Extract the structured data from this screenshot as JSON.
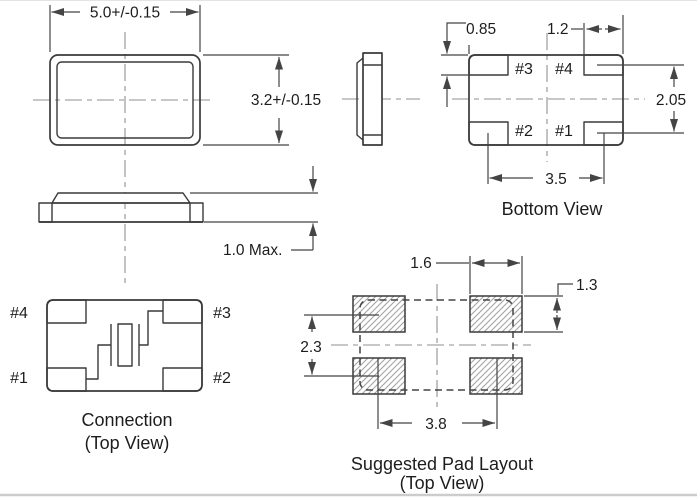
{
  "document": {
    "type": "mechanical-dimension-drawing",
    "units_note": "millimetres"
  },
  "colors": {
    "ink": "#3a3a3a",
    "dim": "#444444",
    "centerline": "#8f8f8f",
    "text": "#1d1d1d",
    "hatch_line": "#a3a3a3",
    "background": "#ffffff",
    "edge_strip": "#cccccc"
  },
  "top_view": {
    "dim_width": "5.0+/-0.15",
    "dim_height": "3.2+/-0.15"
  },
  "side_view": {
    "dim_max_height": "1.0 Max."
  },
  "bottom_view": {
    "title": "Bottom View",
    "pad_tl": "#3",
    "pad_tr": "#4",
    "pad_bl": "#2",
    "pad_br": "#1",
    "dim_pad_height": "0.85",
    "dim_pad_width": "1.2",
    "dim_row_pitch": "2.05",
    "dim_col_pitch": "3.5"
  },
  "connection_view": {
    "title": "Connection",
    "subtitle": "(Top View)",
    "pad_tl": "#4",
    "pad_tr": "#3",
    "pad_bl": "#1",
    "pad_br": "#2"
  },
  "pad_layout": {
    "title": "Suggested Pad Layout",
    "subtitle": "(Top View)",
    "dim_pad_width": "1.6",
    "dim_pad_height": "1.3",
    "dim_row_pitch": "2.3",
    "dim_col_pitch": "3.8"
  }
}
